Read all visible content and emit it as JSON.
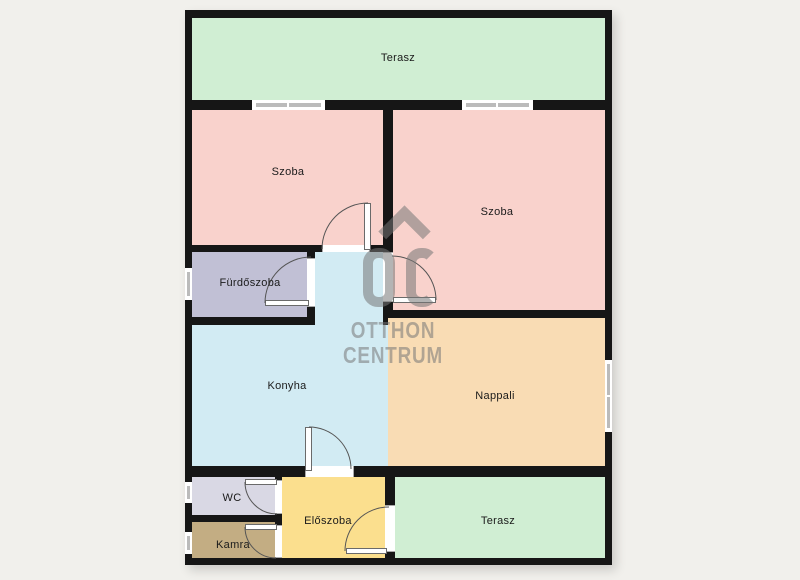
{
  "brand": {
    "watermark_logo": "OC",
    "watermark_line1": "OTTHON",
    "watermark_line2": "CENTRUM",
    "watermark_color": "rgba(118,118,118,0.55)"
  },
  "palette": {
    "background": "#f1f0ec",
    "wall": "#161616",
    "window_glass": "#bbbbbb",
    "door_arc": "#555555"
  },
  "rooms": [
    {
      "id": "terasz-top",
      "label": "Terasz",
      "color": "#d0eed3"
    },
    {
      "id": "szoba-left",
      "label": "Szoba",
      "color": "#f9d2cc"
    },
    {
      "id": "szoba-right",
      "label": "Szoba",
      "color": "#f9d2cc"
    },
    {
      "id": "furdoszoba",
      "label": "Fürdőszoba",
      "color": "#c1c0d5"
    },
    {
      "id": "konyha",
      "label": "Konyha",
      "color": "#d2ebf3"
    },
    {
      "id": "nappali",
      "label": "Nappali",
      "color": "#f9dcb4"
    },
    {
      "id": "wc",
      "label": "WC",
      "color": "#d9d8e4"
    },
    {
      "id": "eloszoba",
      "label": "Előszoba",
      "color": "#fbdf8e"
    },
    {
      "id": "kamra",
      "label": "Kamra",
      "color": "#c3ad83"
    },
    {
      "id": "terasz-bottom",
      "label": "Terasz",
      "color": "#d0eed3"
    }
  ]
}
